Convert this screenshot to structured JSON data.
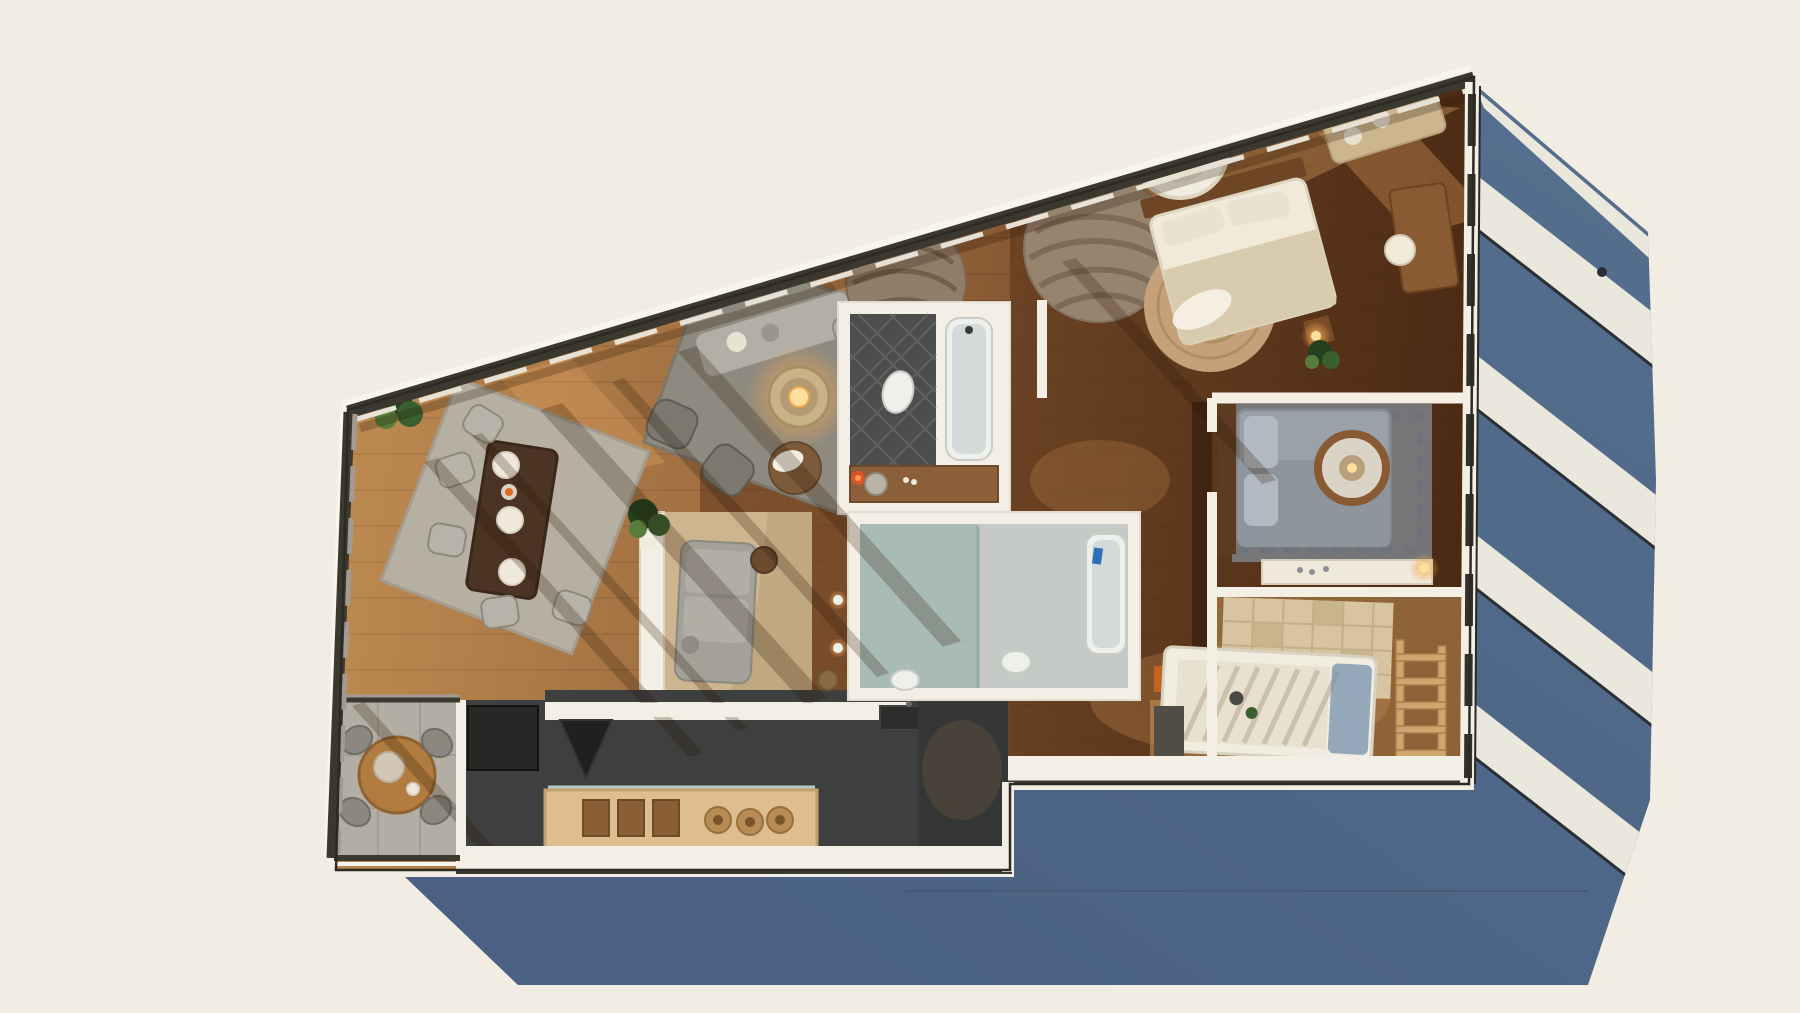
{
  "scene": {
    "kind": "3d-rendered-floor-plan-top-view",
    "canvas": {
      "width": 1800,
      "height": 1013
    },
    "lighting": "daylight-with-long-cast-shadow",
    "shadow": {
      "direction": "lower-right",
      "awning_stripe_count": 5
    }
  },
  "rooms": [
    {
      "id": "dining-area"
    },
    {
      "id": "living-room"
    },
    {
      "id": "study-nook"
    },
    {
      "id": "kitchen"
    },
    {
      "id": "balcony-terrace"
    },
    {
      "id": "corridor"
    },
    {
      "id": "bathroom-primary"
    },
    {
      "id": "bathroom-secondary"
    },
    {
      "id": "master-bedroom"
    },
    {
      "id": "second-bedroom"
    },
    {
      "id": "kids-bedroom"
    },
    {
      "id": "hallway"
    }
  ],
  "furniture": [
    "dining-table",
    "dining-chairs",
    "dining-rug",
    "living-sofa",
    "armchairs",
    "coffee-table-lamp",
    "living-rug",
    "study-sofa",
    "study-cabinet",
    "tall-plant",
    "kitchen-bar-counter",
    "bar-stools",
    "appliance-block",
    "range-hood",
    "balcony-round-table",
    "balcony-chairs",
    "round-corridor-rug",
    "console-shelf",
    "potted-plants",
    "bathtub",
    "toilet",
    "vanity",
    "shower-glass",
    "wash-basin",
    "master-bed",
    "hanging-chair",
    "jute-round-rug",
    "wave-round-rug",
    "bedside-lamp",
    "writing-desk",
    "second-bed",
    "round-ring-rug",
    "dresser-shelf",
    "wardrobe-panel",
    "bunk-bed",
    "wooden-ladder",
    "patchwork-play-mat",
    "kids-desk"
  ],
  "palette": {
    "background": "#f1ede3",
    "shadow_blue": "#546e8d",
    "shadow_blue_deep": "#4a6183",
    "shadow_stripe": "#eae7dc",
    "shadow_stripe_edge": "#2a2e35",
    "shadow_crease": "#46566f",
    "outline": "#2b2a23",
    "wall_white": "#f3efe4",
    "wall_dark": "#3b392f",
    "wall_glass": "#a39b90",
    "window_frame": "#33312a",
    "sill": "#e8e2d6",
    "outer_light": "#f8f5ee",
    "wood_light": "#bb8850",
    "wood_mid": "#96653a",
    "wood_dark": "#6b3d1f",
    "wood_deep": "#4c2a14",
    "corridor_wood": "#5a321b",
    "lit_wood": "#cf995c",
    "tile": "#b3aea3",
    "tile_line": "#9d978c",
    "kitchen_floor": "#3d403f",
    "counter_wood": "#debe8f",
    "counter_edge": "#c2a06c",
    "appliance": "#262825",
    "glass_teal": "#bcd8d4",
    "drawer_wood": "#8a5f35",
    "bath_dark": "#4b4e4d",
    "bath_hatch": "#686b6a",
    "bath_light": "#c6cac6",
    "shower_glass": "#9fb6b2",
    "fixture": "#eef0ec",
    "fixture_edge": "#c9ccc5",
    "water": "#d3dad9",
    "vanity_wood": "#8a5f39",
    "basin": "#b9b3a6",
    "ember": "#e2542a",
    "ember_core": "#ff9b52",
    "towel_blue": "#2f6fb8",
    "rug_dining": "#b6b0a3",
    "rug_living": "#8f8a7f",
    "rug_edge": "#7c776d",
    "rug_round": "#8f7d69",
    "rug_round_line": "#6f5d49",
    "jute": "#c4a178",
    "jute_line": "#ab8a5e",
    "wave_rug": "#97846f",
    "wave_line": "#7b6854",
    "sofa": "#b2afa7",
    "sofa_edge": "#8f8b82",
    "armchair": "#7b786f",
    "armchair_edge": "#5f5c54",
    "study_sofa": "#a3a19a",
    "cushion": "#b0aea6",
    "chair": "#b8b3a8",
    "chair_edge": "#8f897d",
    "table_dark": "#4b3424",
    "table_edge": "#3a281b",
    "plate": "#efe9dc",
    "plate_edge": "#d8d0c0",
    "fruit": "#d96c1f",
    "bed_white": "#f1ead9",
    "bed_edge": "#ded5c0",
    "blanket": "#d8cbae",
    "pillow": "#e9e2d1",
    "headboard": "#6e4626",
    "throw": "#f4efe2",
    "bed2": "#9aa1a8",
    "bed2_edge": "#868d94",
    "bed2_blanket": "#8e959c",
    "bed2_pillow": "#b2b9c0",
    "bed2_head": "#5d3a22",
    "bed2_rug": "#7d8289",
    "bed2_rug_line": "#6d727a",
    "ring_wood": "#8a5a33",
    "ring_center": "#d9d4c6",
    "dresser": "#efe9dc",
    "dresser_edge": "#d6cdb9",
    "patch": "#d6c5a0",
    "patch_dark": "#c5b189",
    "patch_line": "#c2af88",
    "bunk": "#f1ece0",
    "bunk_inner": "#e8e1d0",
    "bunk_edge": "#d8d1c0",
    "slat": "#c6bda6",
    "kid_blue": "#7591ad",
    "ladder": "#cfa76e",
    "ladder_edge": "#a87f4b",
    "wardrobe": "#3f2512",
    "niche": "#d2691e",
    "beige_panel": "#cdb58f",
    "panel_shade": "#b79d76",
    "plant_dark": "#24401f",
    "plant_mid": "#3a6030",
    "plant_light": "#567d3b",
    "pot": "#efeadd",
    "glow_core": "#ffdf9e",
    "glow_mid": "#f5a94f",
    "balcony_table": "#b07c3f",
    "balcony_table_edge": "#8f6230",
    "dome": "#d9d5ca",
    "balcony_chair": "#8a8880",
    "balcony_chair_edge": "#6f6d66",
    "basket": "#8a6a43",
    "console_wood": "#7c4e2a",
    "desk_wood": "#8a5a33",
    "dark_media": "#4f4d45",
    "sun_shadow": "#2a1406",
    "sun_light": "#e0a060"
  }
}
